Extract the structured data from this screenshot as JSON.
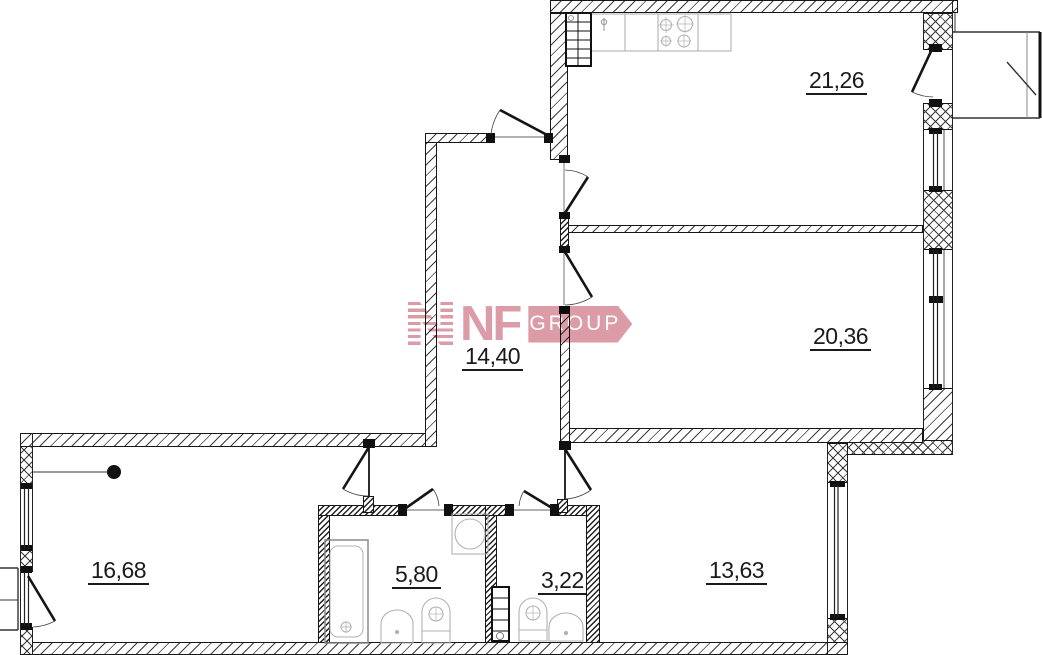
{
  "plan": {
    "title": "apartment floor plan",
    "room_areas": [
      {
        "key": "kitchen-living",
        "label": "21,26"
      },
      {
        "key": "bedroom-right",
        "label": "20,36"
      },
      {
        "key": "hallway",
        "label": "14,40"
      },
      {
        "key": "bedroom-left",
        "label": "16,68"
      },
      {
        "key": "bathroom",
        "label": "5,80"
      },
      {
        "key": "wc",
        "label": "3,22"
      },
      {
        "key": "bedroom-bottom",
        "label": "13,63"
      }
    ]
  },
  "logo": {
    "name": "NF",
    "suffix": "GROUP"
  },
  "colors": {
    "line": "#1a1a1a",
    "fixture": "#b2b2b2",
    "logo_pink": "#d994a0"
  }
}
